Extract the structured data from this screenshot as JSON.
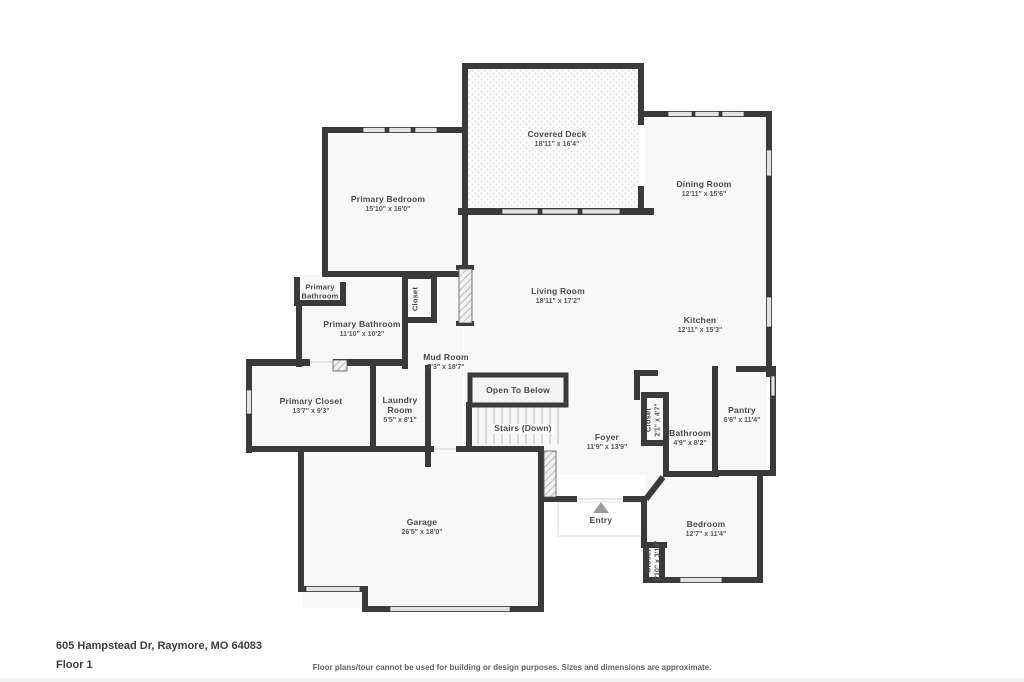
{
  "footer": {
    "address": "605 Hampstead Dr, Raymore, MO 64083",
    "floor_label": "Floor 1",
    "disclaimer": "Floor plans/tour cannot be used for building or design purposes. Sizes and dimensions are approximate."
  },
  "labels": {
    "entry": "Entry"
  },
  "rooms": {
    "primary_bedroom": {
      "name": "Primary Bedroom",
      "dims": "15'10\" x 16'0\""
    },
    "covered_deck": {
      "name": "Covered Deck",
      "dims": "18'11\" x 16'4\""
    },
    "dining_room": {
      "name": "Dining Room",
      "dims": "12'11\" x 15'6\""
    },
    "living_room": {
      "name": "Living Room",
      "dims": "18'11\" x 17'2\""
    },
    "kitchen": {
      "name": "Kitchen",
      "dims": "12'11\" x 15'3\""
    },
    "primary_bathroom_wc": {
      "name": "Primary Bathroom"
    },
    "primary_bathroom": {
      "name": "Primary Bathroom",
      "dims": "11'10\" x 10'2\""
    },
    "closet_hall": {
      "name": "Closet"
    },
    "mud_room": {
      "name": "Mud Room",
      "dims": "7'3\" x 18'7\""
    },
    "primary_closet": {
      "name": "Primary Closet",
      "dims": "13'7\" x 9'3\""
    },
    "laundry_room": {
      "name": "Laundry Room",
      "dims": "5'5\" x 8'1\""
    },
    "open_to_below": {
      "name": "Open To Below"
    },
    "stairs": {
      "name": "Stairs (Down)"
    },
    "foyer": {
      "name": "Foyer",
      "dims": "11'9\" x 13'9\""
    },
    "closet_foyer": {
      "name": "Closet",
      "dims": "2'1\" x 4'7\""
    },
    "bathroom": {
      "name": "Bathroom",
      "dims": "4'9\" x 8'2\""
    },
    "pantry": {
      "name": "Pantry",
      "dims": "6'6\" x 11'4\""
    },
    "garage": {
      "name": "Garage",
      "dims": "26'5\" x 18'0\""
    },
    "bedroom": {
      "name": "Bedroom",
      "dims": "12'7\" x 11'4\""
    },
    "closet_bedroom": {
      "name": "Closet",
      "dims": "1'10\" x 3'10\""
    }
  },
  "colors": {
    "wall": "#3a3a3a",
    "room_fill": "#f8f8f8",
    "window": "#e3e3e3",
    "text": "#4a4a4a",
    "entry_arrow": "#9b9b9b"
  }
}
